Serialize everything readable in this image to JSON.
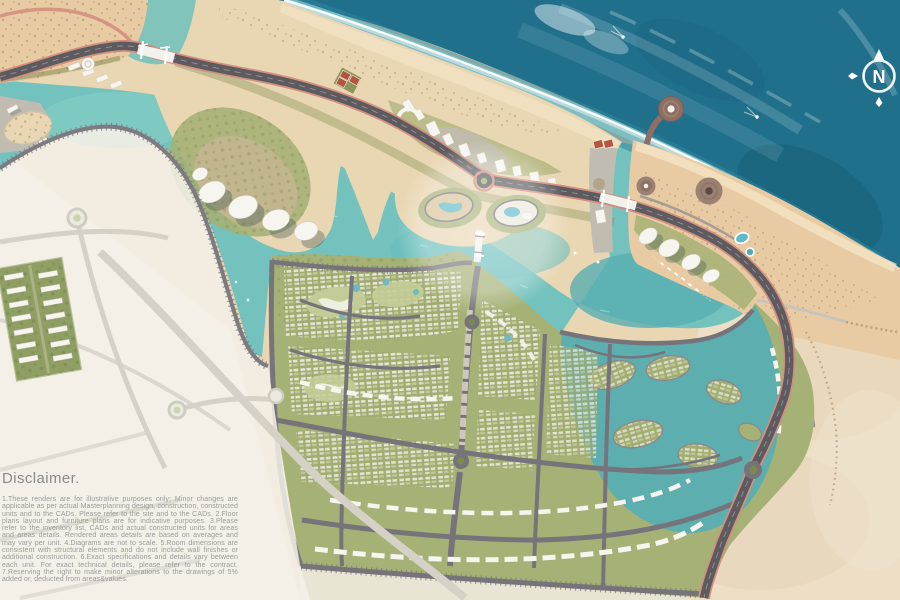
{
  "compass": {
    "label": "N"
  },
  "disclaimer": {
    "heading": "Disclaimer.",
    "body": "1.These renders are for illustrative purposes only; Minor changes are applicable as per actual Masterplanning design, construction, constructed units and to the CADs. Please refer to the site and to the CADs. 2.Floor plans layout and furniture plans are for indicative purposes. 3.Please refer to the inventory list, CADs and actual constructed units for areas and areas details. Rendered areas details are based on averages and may vary per unit. 4.Diagrams are not to scale. 5.Room dimensions are consistent with structural elements and do not include wall finishes or additional construction. 6.Exact specifications and details vary between each unit. For exact technical details, please refer to the contract. 7.Reserving the right to make minor alterations to the drawings of 5% added or, deducted from areas&values."
  },
  "palette": {
    "sea-deep": "#20708c",
    "sea-dark": "#15556b",
    "lagoon": "#74c2bd",
    "lagoon-deep": "#57aeb2",
    "channel": "#aed3d8",
    "sand": "#e9d6b2",
    "sand-pink": "#e8cba3",
    "sand-pale": "#f1ece1",
    "green": "#a6b176",
    "green-dark": "#7c8a4e",
    "green-light": "#c3cc96",
    "building": "#f7f5ef",
    "terrace": "#c1bcb2",
    "brown-plaza": "#97796b",
    "pier": "#8d6f63",
    "court-red": "#b5543f",
    "road-dark": "#5d5b5f",
    "road-edge": "#d2907e",
    "road-mid": "#76747a",
    "road-light": "#8b898d",
    "road-faint": "#d5d1c7",
    "foam": "#ffffff",
    "text-gray": "#939393"
  }
}
